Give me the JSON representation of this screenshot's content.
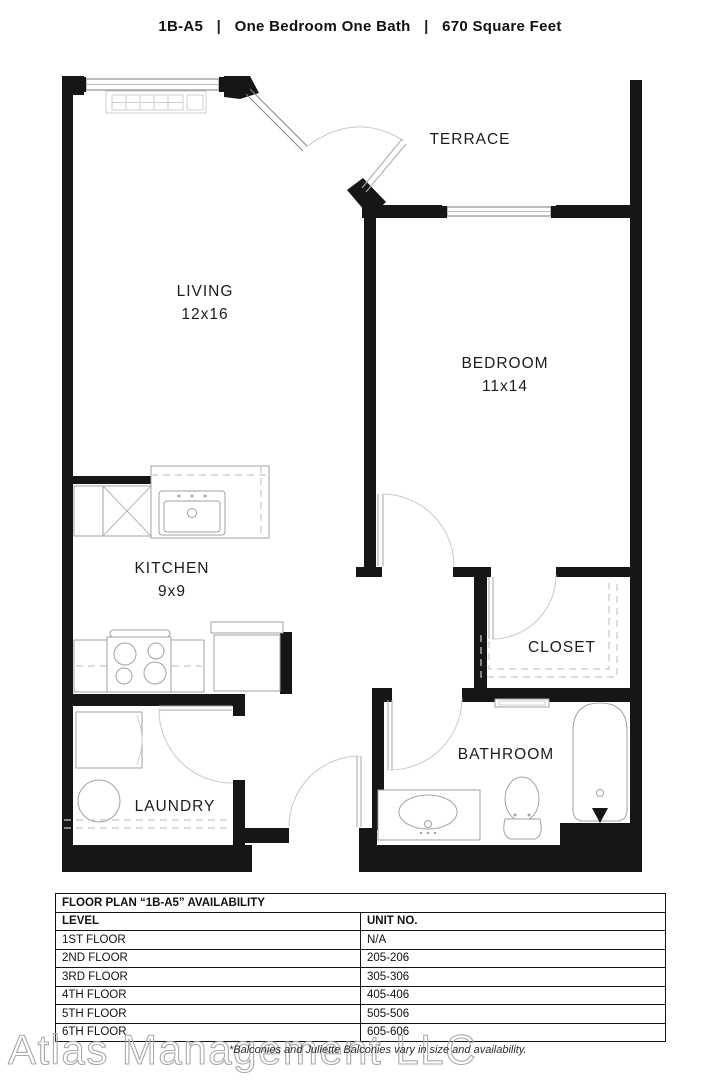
{
  "title": {
    "unit": "1B-A5",
    "divider": "|",
    "type": "One Bedroom One Bath",
    "area": "670 Square Feet"
  },
  "floorplan": {
    "terrace": {
      "name": "TERRACE"
    },
    "living": {
      "name": "LIVING",
      "dim": "12x16"
    },
    "bedroom": {
      "name": "BEDROOM",
      "dim": "11x14"
    },
    "kitchen": {
      "name": "KITCHEN",
      "dim": "9x9"
    },
    "closet": {
      "name": "CLOSET"
    },
    "laundry": {
      "name": "LAUNDRY"
    },
    "bathroom": {
      "name": "BATHROOM"
    }
  },
  "availability": {
    "title": "FLOOR PLAN “1B-A5” AVAILABILITY",
    "columns": [
      "LEVEL",
      "UNIT NO."
    ],
    "rows": [
      [
        "1ST FLOOR",
        "N/A"
      ],
      [
        "2ND FLOOR",
        "205-206"
      ],
      [
        "3RD FLOOR",
        "305-306"
      ],
      [
        "4TH FLOOR",
        "405-406"
      ],
      [
        "5TH FLOOR",
        "505-506"
      ],
      [
        "6TH FLOOR",
        "605-606"
      ]
    ]
  },
  "watermark": "Atlas Management LLC",
  "disclaimer": "*Balconies and Juliette Balconies vary in size and availability.",
  "colors": {
    "wall": "#161616",
    "fixture": "#a2a2a2",
    "text": "#1c1c1c"
  }
}
